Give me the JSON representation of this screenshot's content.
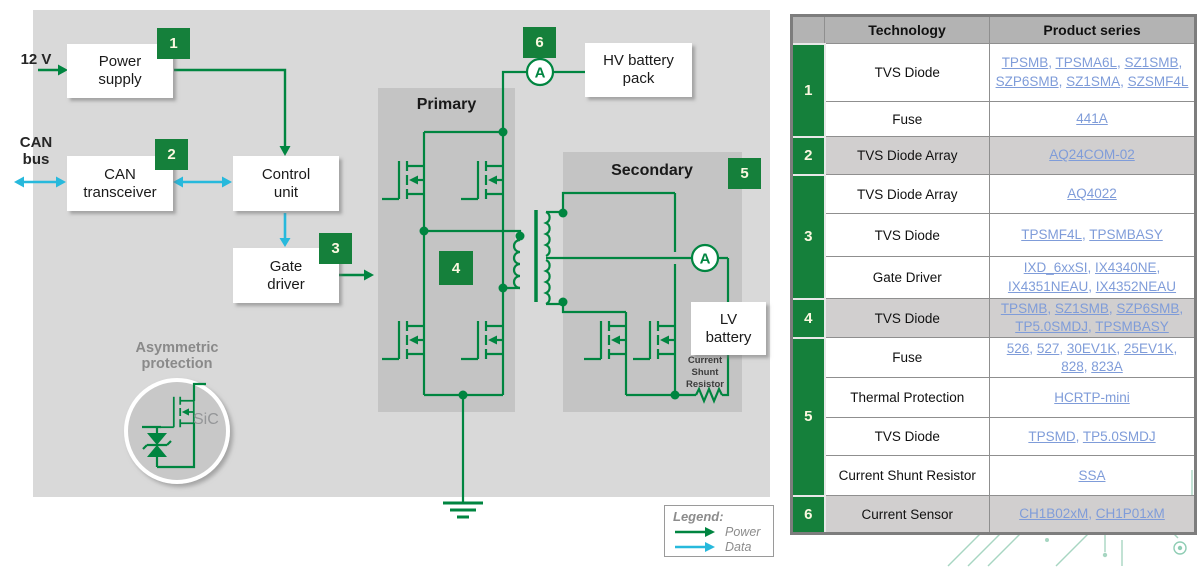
{
  "diagram": {
    "labels": {
      "v12": "12 V",
      "can_bus": "CAN\nbus",
      "power_supply": "Power\nsupply",
      "can_transceiver": "CAN\ntransceiver",
      "control_unit": "Control\nunit",
      "gate_driver": "Gate\ndriver",
      "hv_battery": "HV battery\npack",
      "lv_battery": "LV\nbattery",
      "primary": "Primary",
      "secondary": "Secondary",
      "asymmetric_protection": "Asymmetric\nprotection",
      "sic": "SiC",
      "current_shunt_resistor": "Current\nShunt\nResistor"
    },
    "badges": [
      "1",
      "2",
      "3",
      "4",
      "5",
      "6"
    ],
    "ammeter_label": "A",
    "legend": {
      "title": "Legend:",
      "power": "Power",
      "data": "Data"
    },
    "colors": {
      "wire_green": "#008540",
      "data_cyan": "#27b9dc",
      "badge_green": "#15803B",
      "canvas_gray": "#d9d9d9",
      "block_gray": "#c4c4c4"
    }
  },
  "table": {
    "headers": [
      "",
      "Technology",
      "Product series"
    ],
    "link_color": "#7f9cd9",
    "groups": [
      {
        "num": "1",
        "rows": [
          {
            "tech": "TVS Diode",
            "products": [
              "TPSMB",
              "TPSMA6L",
              "SZ1SMB",
              "SZP6SMB",
              "SZ1SMA",
              "SZSMF4L"
            ]
          },
          {
            "tech": "Fuse",
            "products": [
              "441A"
            ]
          }
        ]
      },
      {
        "num": "2",
        "rows": [
          {
            "tech": "TVS Diode Array",
            "products": [
              "AQ24COM-02"
            ]
          }
        ]
      },
      {
        "num": "3",
        "rows": [
          {
            "tech": "TVS Diode Array",
            "products": [
              "AQ4022"
            ]
          },
          {
            "tech": "TVS Diode",
            "products": [
              "TPSMF4L",
              "TPSMBASY"
            ]
          },
          {
            "tech": "Gate Driver",
            "products": [
              "IXD_6xxSI",
              "IX4340NE",
              "IX4351NEAU",
              "IX4352NEAU"
            ]
          }
        ]
      },
      {
        "num": "4",
        "rows": [
          {
            "tech": "TVS Diode",
            "products": [
              "TPSMB",
              "SZ1SMB",
              "SZP6SMB",
              "TP5.0SMDJ",
              "TPSMBASY"
            ]
          }
        ]
      },
      {
        "num": "5",
        "rows": [
          {
            "tech": "Fuse",
            "products": [
              "526",
              "527",
              "30EV1K",
              "25EV1K",
              "828",
              "823A"
            ]
          },
          {
            "tech": "Thermal Protection",
            "products": [
              "HCRTP-mini"
            ]
          },
          {
            "tech": "TVS Diode",
            "products": [
              "TPSMD",
              "TP5.0SMDJ"
            ]
          },
          {
            "tech": "Current Shunt Resistor",
            "products": [
              "SSA"
            ]
          }
        ]
      },
      {
        "num": "6",
        "rows": [
          {
            "tech": "Current Sensor",
            "products": [
              "CH1B02xM",
              "CH1P01xM"
            ]
          }
        ]
      }
    ]
  }
}
